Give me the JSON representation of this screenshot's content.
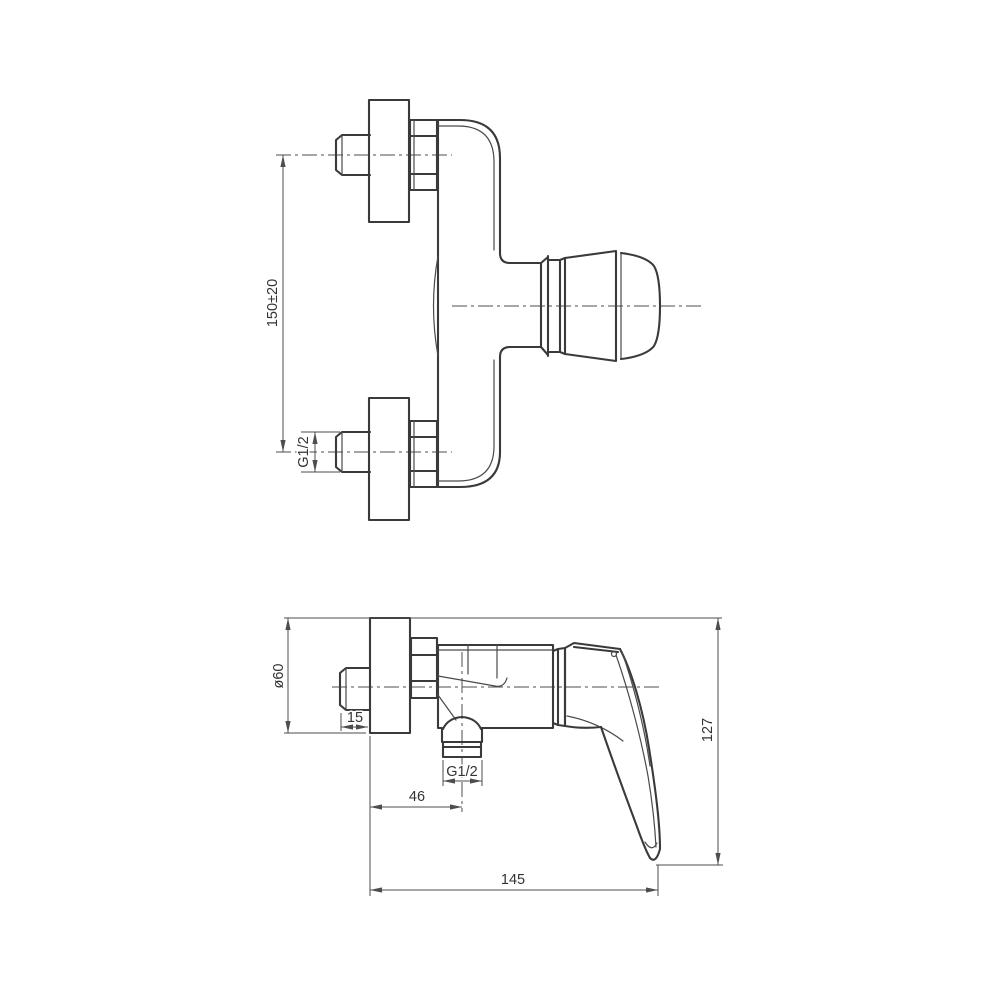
{
  "page": {
    "background_color": "#ffffff",
    "line_color": "#3a3a3a",
    "dim_line_color": "#4d4d4d",
    "dim_text_color": "#333333"
  },
  "front_view": {
    "dim_mount_distance": "150±20",
    "dim_inlet_thread": "G1/2"
  },
  "side_view": {
    "dim_flange_diameter": "ø60",
    "dim_eccentric_offset": "15",
    "dim_outlet_thread": "G1/2",
    "dim_outlet_from_wall": "46",
    "dim_overall_height": "127",
    "dim_overall_depth": "145"
  }
}
